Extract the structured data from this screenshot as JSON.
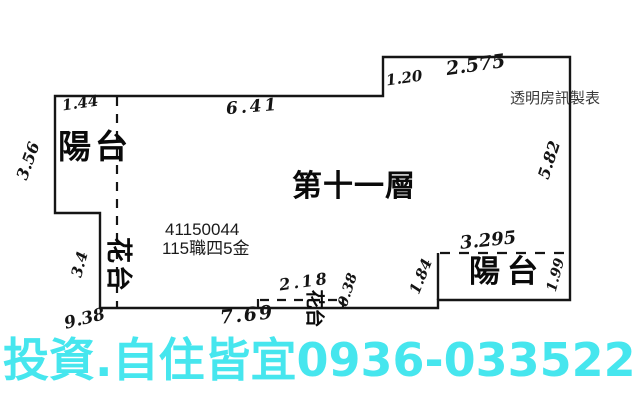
{
  "title": {
    "maker": "透明房訊製表",
    "floor": "第十一層"
  },
  "annotations": {
    "listing_id": "41150044",
    "listing_code": "115職四5金"
  },
  "rooms": {
    "balcony_left": "陽台",
    "flowerbed_left": "花台",
    "balcony_right": "陽台",
    "flowerbed_bottom": "花台"
  },
  "dimensions": {
    "top_left": "1.44",
    "top": "6.41",
    "top_step": "1.20",
    "top_right": "2.575",
    "left": "3.56",
    "flowerbed_left": "3.4",
    "right": "5.82",
    "balcony_right_top": "3.295",
    "balcony_right_left": "1.84",
    "balcony_right_right": "1.99",
    "notch_top": "2.18",
    "notch_depth": "0.38",
    "bottom_left_corner": "9.38",
    "bottom": "7.69"
  },
  "ad": {
    "text": "投資.自住皆宜0936-033522"
  },
  "colors": {
    "line": "#151515",
    "ad_text": "#46e6ee",
    "maker_text": "#3a3a3a"
  }
}
